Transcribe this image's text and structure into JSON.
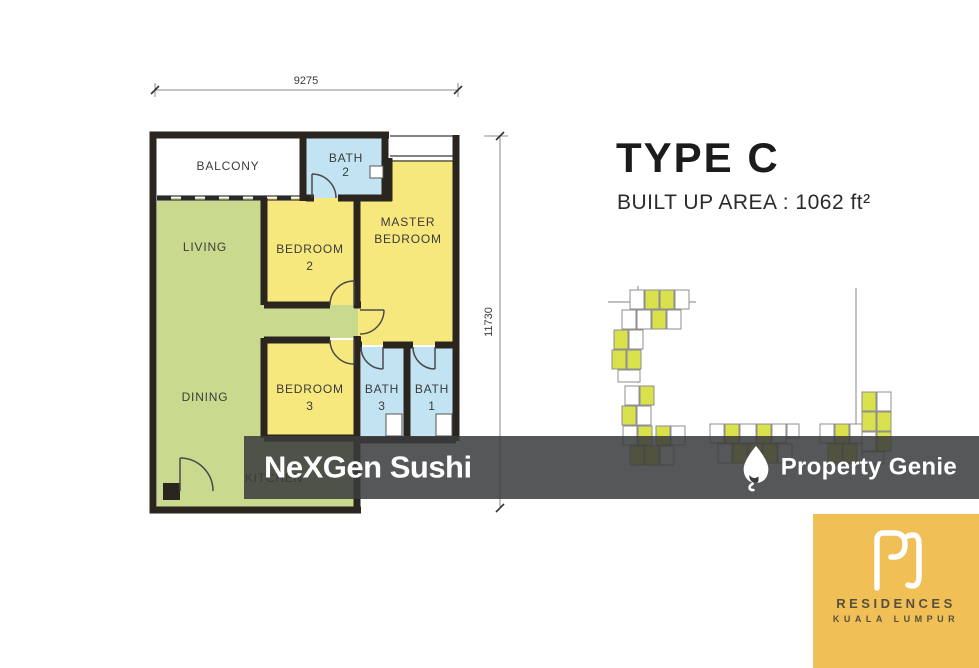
{
  "title": {
    "type_label": "TYPE C",
    "built_up": "BUILT UP AREA : 1062 ft²"
  },
  "floorplan": {
    "dim_top": "9275",
    "dim_right": "11730",
    "rooms": {
      "balcony": {
        "label": "BALCONY",
        "sub": ""
      },
      "bath2": {
        "label": "BATH",
        "sub": "2"
      },
      "master": {
        "label": "MASTER",
        "sub": "BEDROOM"
      },
      "bedroom2": {
        "label": "BEDROOM",
        "sub": "2"
      },
      "living": {
        "label": "LIVING",
        "sub": ""
      },
      "dining": {
        "label": "DINING",
        "sub": ""
      },
      "bedroom3": {
        "label": "BEDROOM",
        "sub": "3"
      },
      "bath3": {
        "label": "BATH",
        "sub": "3"
      },
      "bath1": {
        "label": "BATH",
        "sub": "1"
      },
      "kitchen": {
        "label": "KITCHEN",
        "sub": ""
      }
    }
  },
  "watermarks": {
    "left": "NeXGen Sushi",
    "right": "Property Genie"
  },
  "logo": {
    "monogram": "RC",
    "line1": "RESIDENCES",
    "line2": "KUALA LUMPUR"
  },
  "palette": {
    "room_green": "#c9da8e",
    "room_yellow": "#f7e87d",
    "room_blue": "#c2e4f2",
    "wall": "#2a251f",
    "keyplan_highlight": "#d9e24c",
    "watermark_band": "rgba(58,59,61,0.86)",
    "logo_gold": "#f0bf55"
  }
}
